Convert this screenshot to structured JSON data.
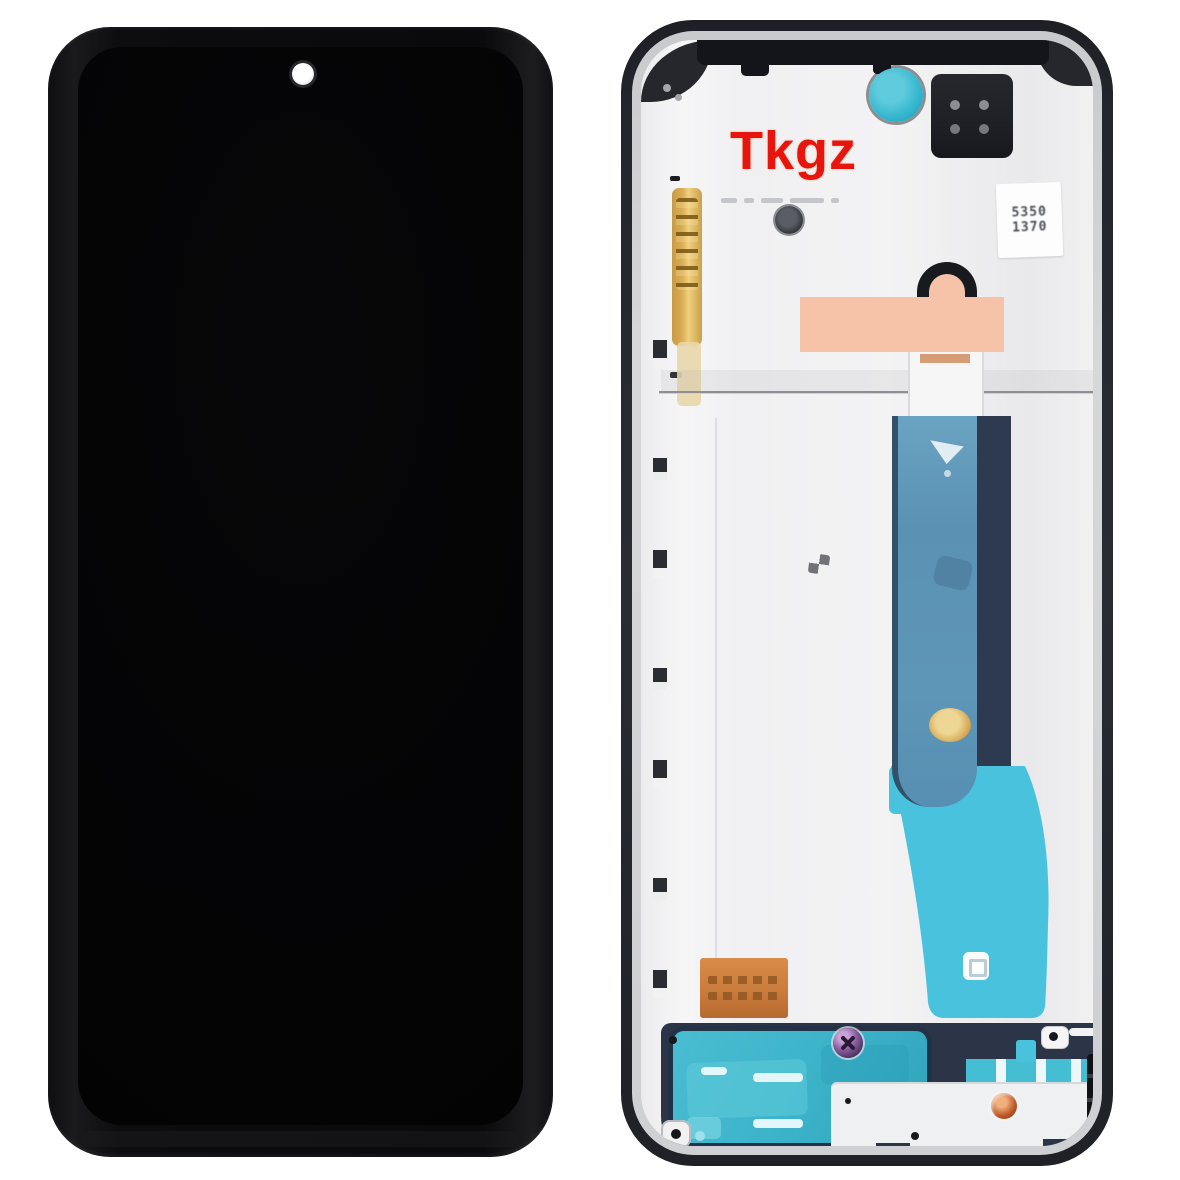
{
  "watermark": {
    "text": "Tkgz",
    "color": "#e8140e"
  },
  "label_sticker": {
    "line1": "5350",
    "line2": "1370"
  },
  "front_panel": {
    "frame": "#121316",
    "screen": "#060608",
    "punch_hole": "#ffffff"
  },
  "back_frame_colors": {
    "frame": "#24262d",
    "inner_lip": "#d6d7d9",
    "backplate": "#f0f0f2",
    "top_trim": "#14151a",
    "adhesive_dot_teal": "#31b4cc",
    "camera_bracket": "#1f2026",
    "gold_flex": "#dcae55",
    "peach_pad": "#f6c3a9",
    "orange_flex": "#ca7c3c",
    "main_flex_blue": "#5e96b8",
    "flex_backing_navy": "#2d3a50",
    "flex_cyan": "#49c3dd",
    "speaker_teal": "#3cb2c9",
    "bottom_band_navy": "#2b3547",
    "screw_purple": "#8a5fa0",
    "screw_orange": "#c05a2a",
    "sticker_text": "#4a4e56"
  }
}
